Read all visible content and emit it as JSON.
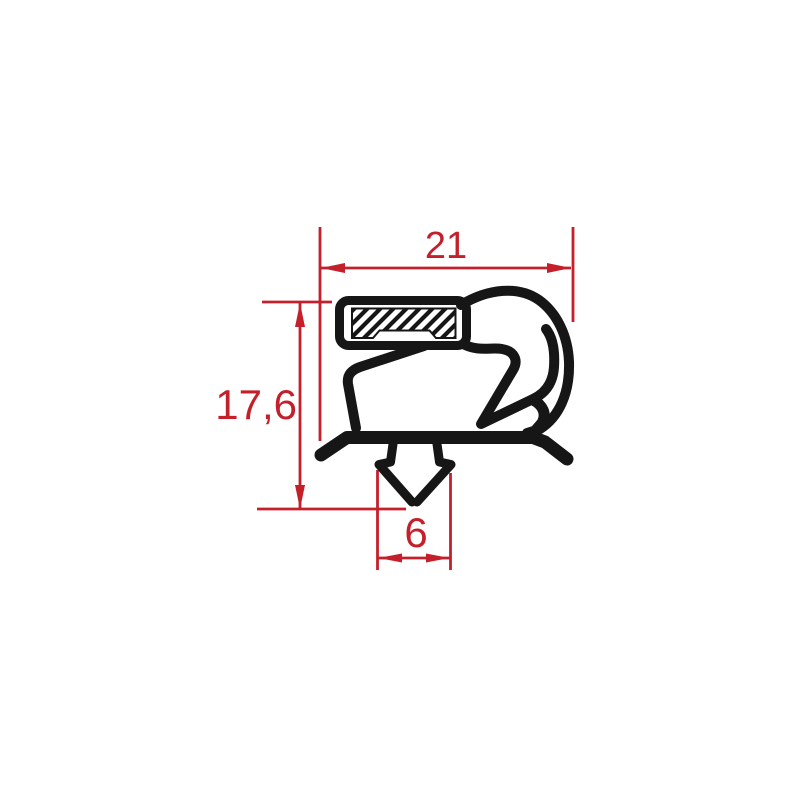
{
  "drawing": {
    "profile_color": "#161616",
    "dimension_color": "#c4202c",
    "pocket_fill": "#ffffff",
    "hatch_style": "diagonal-lines",
    "dimensions": {
      "top_width": {
        "value": "21"
      },
      "left_height": {
        "value": "17,6"
      },
      "bottom_width": {
        "value": "6"
      }
    }
  }
}
